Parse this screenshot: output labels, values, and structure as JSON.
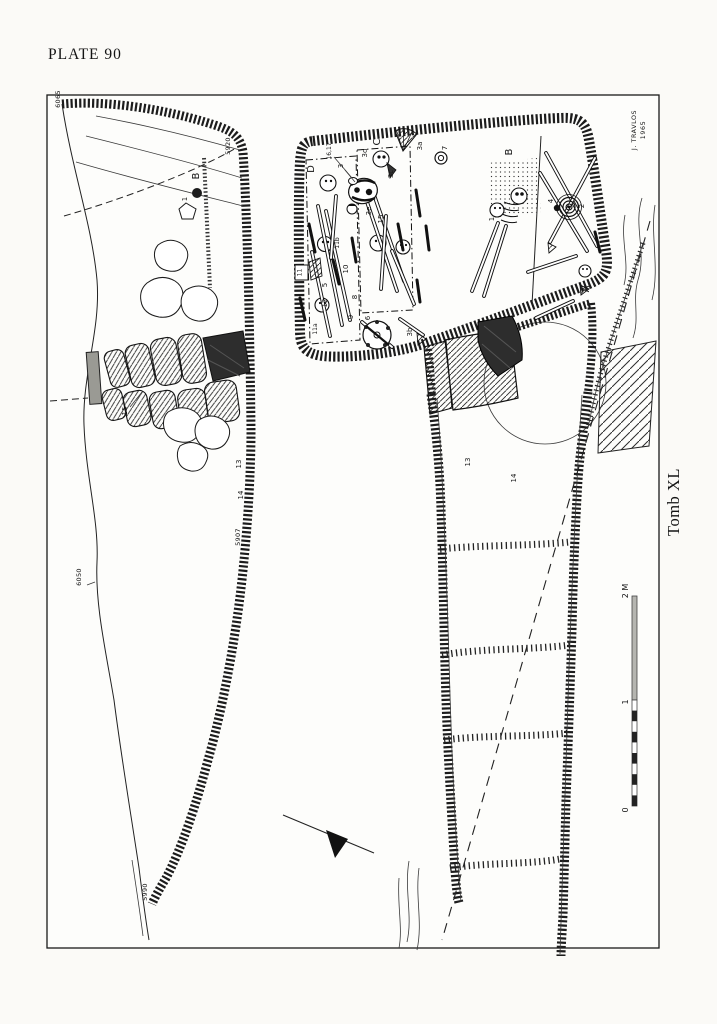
{
  "page": {
    "plate_title": "PLATE 90"
  },
  "margin": {
    "credit_name": "J. TRAVLOS",
    "credit_year": "1965",
    "tomb_caption": "Tomb XL"
  },
  "scale_bar": {
    "zero": "0",
    "one": "1",
    "two": "2 M"
  },
  "upper_plan": {
    "elev_top": "6065",
    "elev_right": "5920",
    "elev_mid": "5907",
    "elev_left": "6050",
    "elev_bottom": "5990",
    "area_b": "B",
    "find_1": "1",
    "find_13": "13",
    "find_14": "14",
    "find_15": "15"
  },
  "chamber": {
    "area_a": "A",
    "area_b": "B",
    "area_c": "C",
    "area_d": "D",
    "find_1": "1",
    "find_2": "2",
    "find_3": "3",
    "find_3a": "3a",
    "find_3b": "3b",
    "find_3c": "3c",
    "find_3d": "3d",
    "find_3e": "3e",
    "find_4": "4",
    "find_5": "5",
    "find_6": "6",
    "find_7": "7",
    "find_8": "8",
    "find_9": "9",
    "find_10": "10",
    "find_11": "11",
    "find_11a": "11a",
    "find_11b": "11b",
    "find_12": "12",
    "find_15": "15",
    "find_16_17": "16,17"
  },
  "dromos": {
    "find_13": "13",
    "find_14": "14"
  }
}
